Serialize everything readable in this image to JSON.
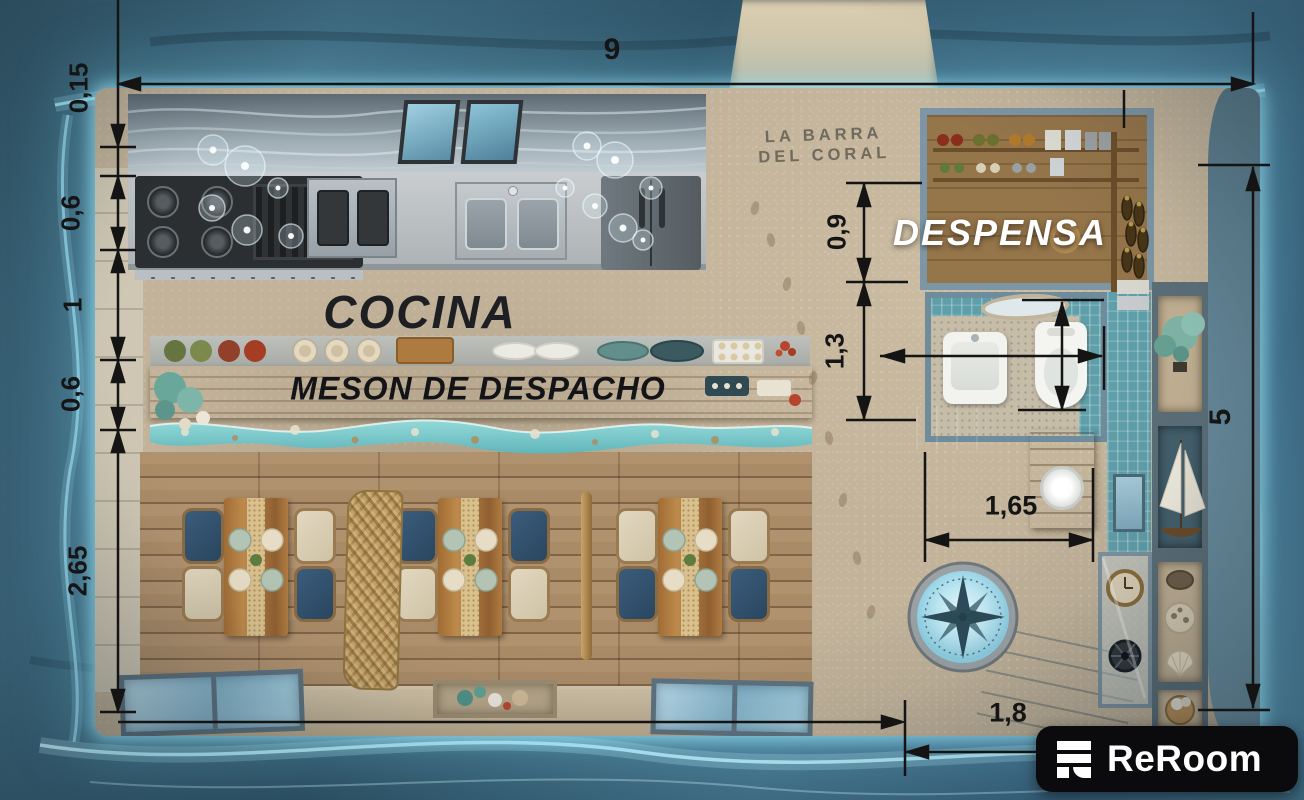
{
  "plan": {
    "rooms": {
      "kitchen_label": "COCINA",
      "counter_label": "MESON DE DESPACHO",
      "pantry_label": "DESPENSA",
      "bar_label_line1": "LA BARRA",
      "bar_label_line2": "DEL CORAL"
    },
    "dimensions": {
      "total_width": "9",
      "wall_offset": "0,15",
      "kitchen_depth": "0,6",
      "kitchen_aisle": "1",
      "counter_depth": "0,6",
      "dining_depth": "2,65",
      "pantry_depth": "0,9",
      "bathroom_depth": "1,3",
      "bathroom_width": "1,65",
      "entrance_width": "1,8",
      "right_side_height": "5"
    },
    "colors": {
      "water_deep": "#2f5468",
      "water_glow": "#aee8f7",
      "sand": "#d2c3a6",
      "wood_counter": "#a9763f",
      "resin_wave": "#74c7cc",
      "chair_navy": "#31506c",
      "chair_cream": "#d9cfb6",
      "bath_tile": "#5f9faa",
      "dimension_ink": "#141414",
      "watermark_bg": "#0b0b0d"
    }
  },
  "watermark": {
    "brand": "ReRoom"
  }
}
